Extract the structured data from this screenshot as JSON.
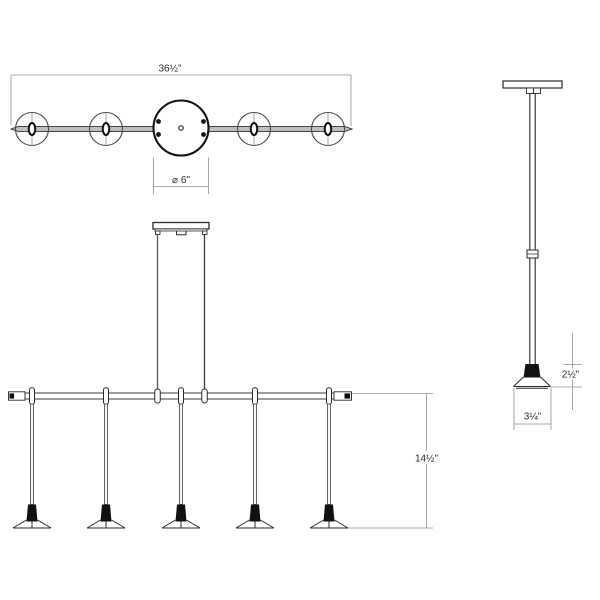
{
  "drawing": {
    "pendant_count": 5,
    "views": {
      "top": {
        "overall_width_label": "36½\"",
        "canopy_diameter_label": "⌀ 6\""
      },
      "front": {
        "drop_height_label": "14½\""
      },
      "side": {
        "shade_height_label": "2½\"",
        "shade_width_label": "3¼\""
      }
    }
  },
  "colors": {
    "background": "#ffffff",
    "line": "#2a2a2a",
    "dim_line": "#8f8f8f",
    "bar_fill": "#bfbfbf",
    "socket_fill": "#111111",
    "text": "#2b2b2b"
  }
}
